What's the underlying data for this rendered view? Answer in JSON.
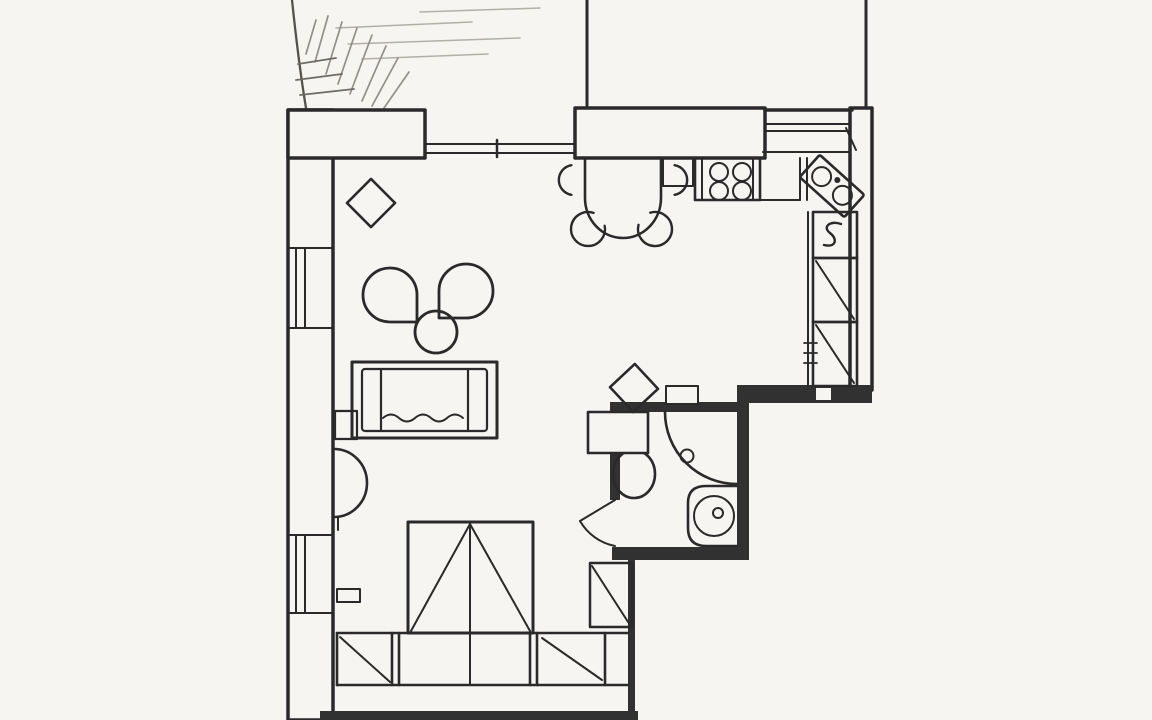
{
  "canvas": {
    "width": 1152,
    "height": 720,
    "background": "#f6f5f2",
    "ink": "#2a2a2a",
    "wall_fill": "#313131",
    "pencil_light": "#b3afa8",
    "pencil_mid": "#938f89",
    "pencil_dark": "#6e6a64",
    "arc_color": "#55524e"
  },
  "plan": {
    "kind": "apartment-floor-plan",
    "style": "scanned hand-drawn line drawing, no text labels visible",
    "rooms": [
      {
        "name": "living-room",
        "items": [
          "rotated-stool",
          "armchair-left",
          "armchair-right",
          "round-coffee-table",
          "sofa",
          "side-shelf",
          "entry-swing-arc"
        ]
      },
      {
        "name": "kitchen-dining",
        "items": [
          "half-round-dining-table",
          "dining-chairs",
          "wall-pillar",
          "cooktop-four-burners",
          "counter",
          "corner-double-basin-sink",
          "small-appliance-cabinet",
          "tall-cabinets"
        ]
      },
      {
        "name": "bathroom",
        "items": [
          "toilet-with-cistern",
          "corner-shower",
          "round-washbasin",
          "door-swing",
          "rotated-stool",
          "chimney-bump"
        ]
      },
      {
        "name": "storage-wall",
        "items": [
          "triangle-front-wardrobe",
          "closet-cells-with-diagonals",
          "duct-shaft"
        ]
      }
    ],
    "windows": [
      {
        "wall": "left",
        "count": 2
      },
      {
        "wall": "top",
        "count": 1,
        "note": "wide balcony window between wall blocks"
      },
      {
        "wall": "top-right",
        "count": 1,
        "note": "kitchen window above counter"
      }
    ],
    "sketch": "curved terrace outline with pencil hatching, top-left",
    "dining_chair_count": 4,
    "burner_count": 4
  }
}
